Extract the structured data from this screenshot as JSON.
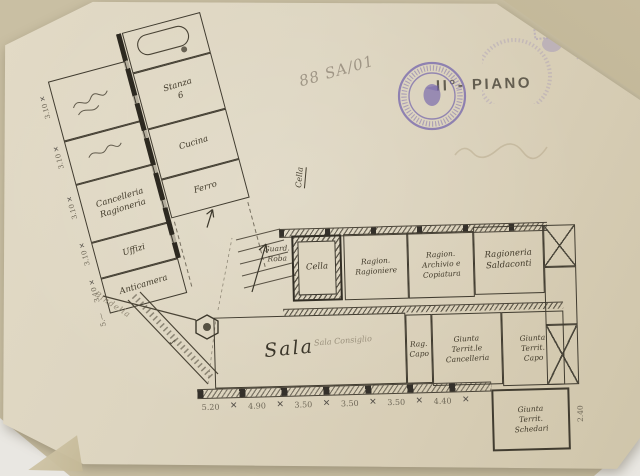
{
  "annotations": {
    "floor_label": "II°- PIANO",
    "reference_number": "88 SA/01",
    "check_mark": "✓",
    "x_mark": "✕"
  },
  "plan": {
    "wing": {
      "rooms_left": [
        "",
        "",
        "Cancelleria\nRagioneria",
        "Uffizi",
        "Anticamera"
      ],
      "rooms_right": [
        "",
        "Stanza\n6",
        "Cucina",
        "Ferro"
      ],
      "dims_left": [
        "3.10",
        "3.10",
        "3.10",
        "3.10",
        "3.10",
        "5.—"
      ]
    },
    "center": {
      "cella_callout": "Cella",
      "guardaroba_label": "Guard.\nRoba",
      "cella_room_label": "Cella",
      "diagonal_note": "Bindella"
    },
    "office_rooms": [
      "Ragion.\nRagioniere",
      "Ragion.\nArchivio e\nCopiatura",
      "Ragioneria\nSaldaconti"
    ],
    "hall": {
      "label": "Sala",
      "pencil_label": "Sala Consiglio"
    },
    "south_rooms": [
      "Rag.\nCapo",
      "Giunta\nTerrit.le\nCancelleria",
      "Giunta\nTerrit.\nCapo"
    ],
    "corner_room": "Giunta\nTerrit.\nSchedari",
    "dims_bottom": [
      "5.20",
      "4.90",
      "3.50",
      "3.50",
      "3.50",
      "4.40"
    ],
    "dim_right": "2.40"
  }
}
